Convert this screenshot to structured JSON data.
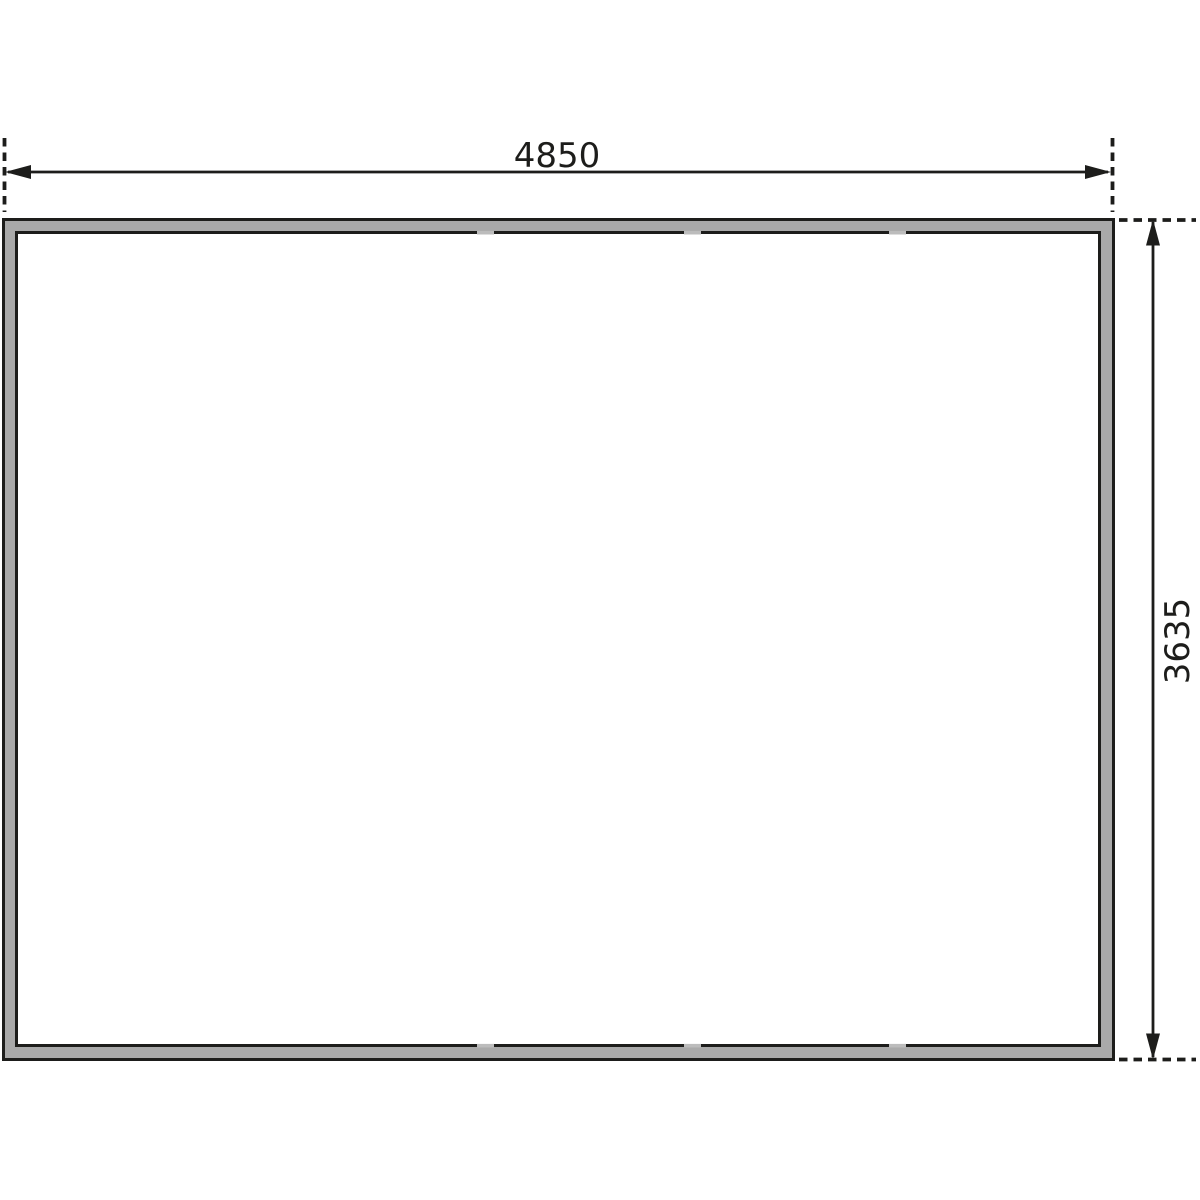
{
  "drawing": {
    "type": "floor-plan-dimension-drawing",
    "dimensions": {
      "width": {
        "label": "4850"
      },
      "height": {
        "label": "3635"
      }
    },
    "colors": {
      "line": "#1d1d1b",
      "wall_fill": "#a9a9a9",
      "joint_mark": "#bcbcbc",
      "interior": "#ffffff",
      "background": "#ffffff"
    }
  }
}
